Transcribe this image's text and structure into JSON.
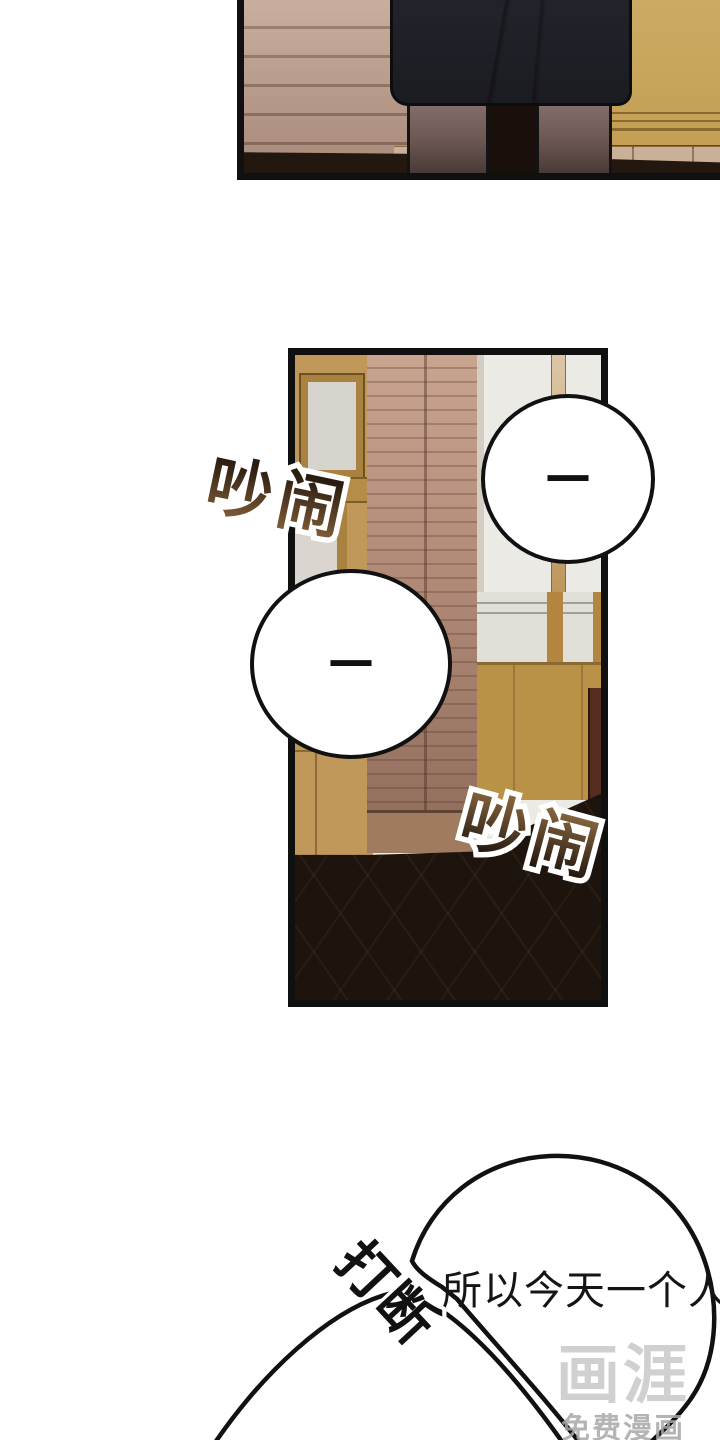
{
  "comic": {
    "sfx": {
      "noisy_left": "吵闹",
      "noisy_right": "吵闹",
      "interrupt": "打断"
    },
    "dialog": {
      "line": "所以今天一个人，"
    },
    "bubbles": {
      "pause_dash_1": "—",
      "pause_dash_2": "—"
    },
    "watermark": {
      "logo": "画涯",
      "tagline": "免费漫画"
    },
    "colors": {
      "panel_border": "#101010",
      "wood_wall": "#bfa090",
      "cabinet_wood": "#c8a35c",
      "slat_door": "#b08977",
      "wall_white": "#eceae4",
      "wainscot": "#b99147",
      "floor_dark": "#1d140d",
      "skirt_dark": "#23232b",
      "sfx_brown": "#86623a",
      "sfx_dark": "#2a1c10",
      "watermark_gray": "#c8c8c8"
    }
  }
}
